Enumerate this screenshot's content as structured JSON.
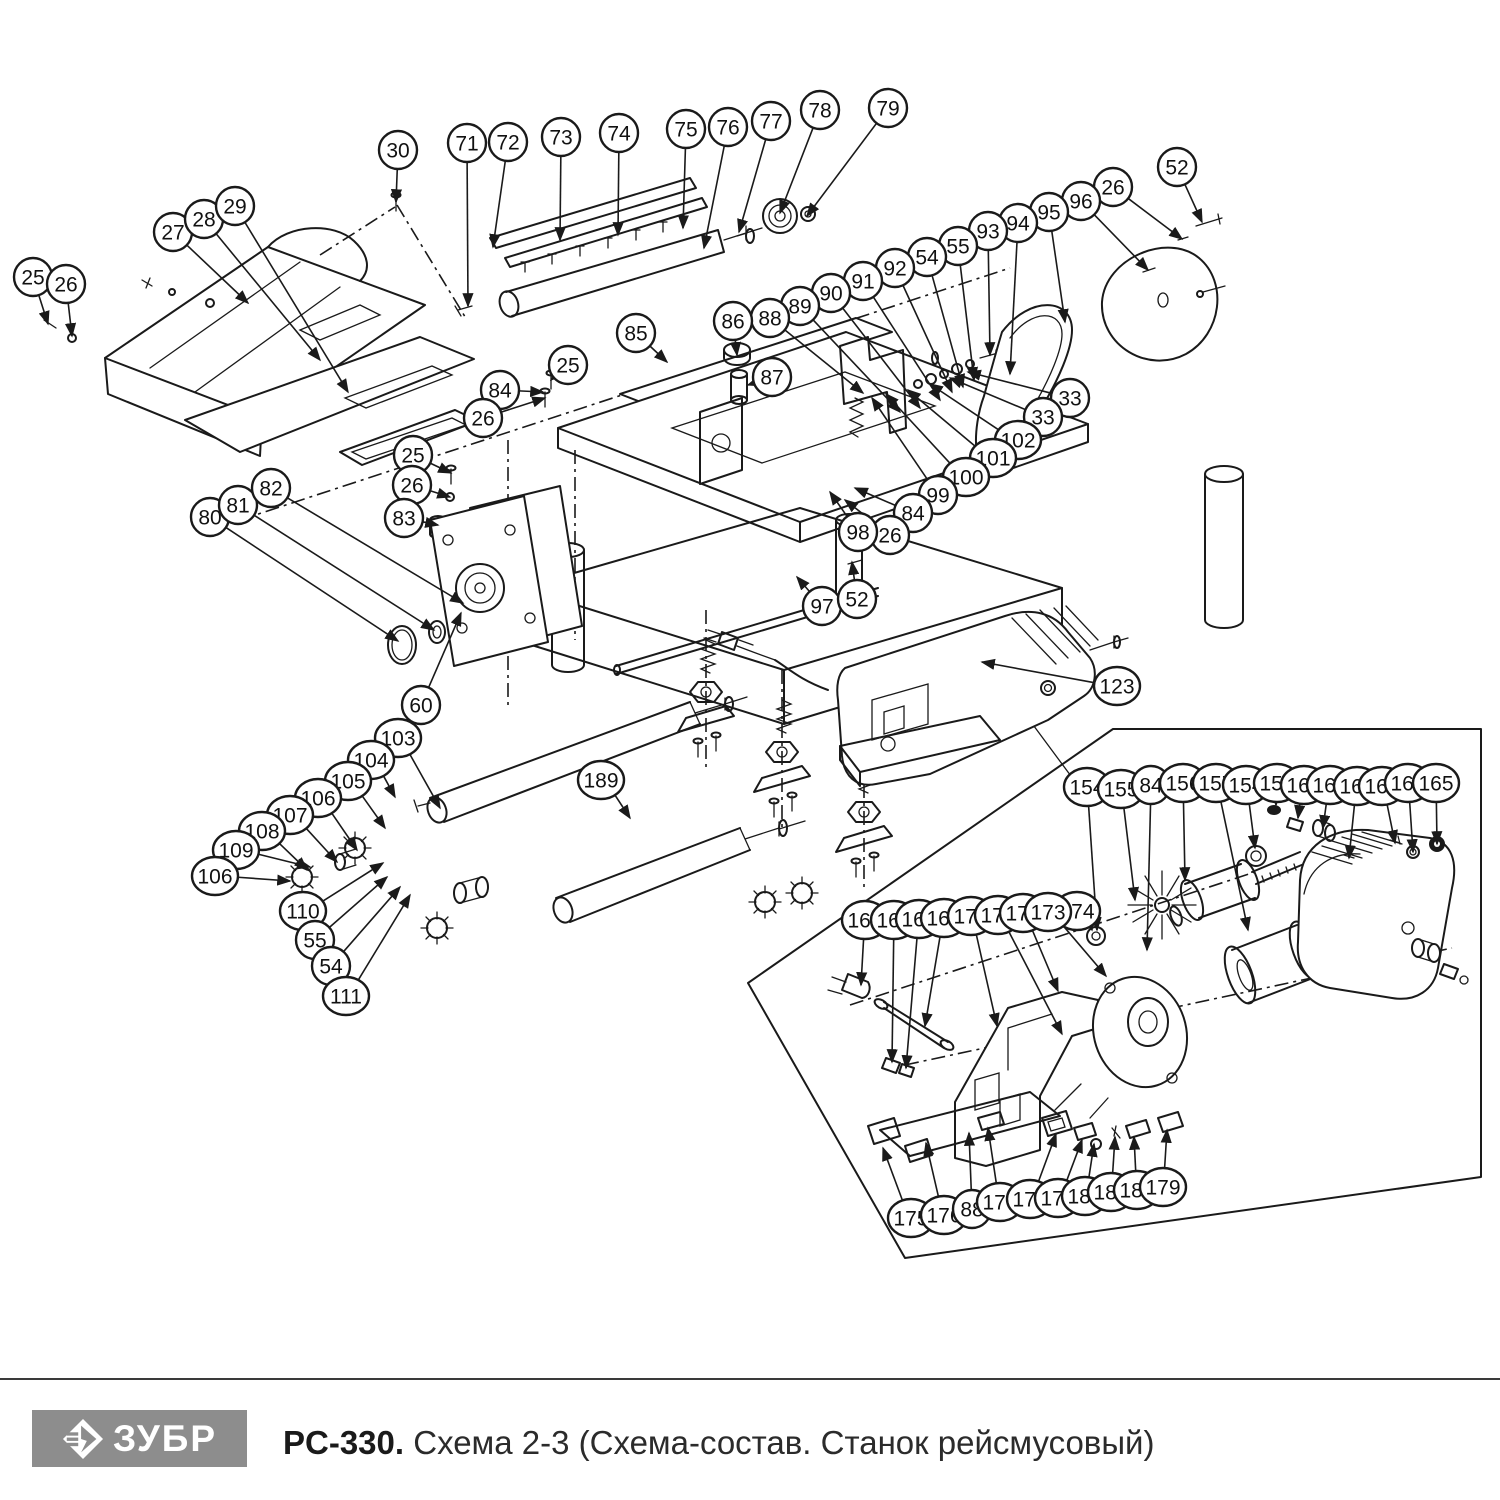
{
  "page": {
    "background": "#ffffff",
    "line_color": "#1a1a1a"
  },
  "footer": {
    "brand": "ЗУБР",
    "logo_icon": "zubr-diamond-arrow-icon",
    "logo_bg": "#8d8d8d",
    "logo_text_color": "#ffffff",
    "model": "PC-330.",
    "caption": " Схема 2-3 (Схема-состав. Станок рейсмусовый)"
  },
  "callouts": [
    {
      "n": "25",
      "x": 33,
      "y": 277,
      "tx": 48,
      "ty": 324
    },
    {
      "n": "26",
      "x": 66,
      "y": 284,
      "tx": 72,
      "ty": 336
    },
    {
      "n": "27",
      "x": 173,
      "y": 232,
      "tx": 248,
      "ty": 303
    },
    {
      "n": "28",
      "x": 204,
      "y": 219,
      "tx": 320,
      "ty": 360
    },
    {
      "n": "29",
      "x": 235,
      "y": 206,
      "tx": 348,
      "ty": 392
    },
    {
      "n": "30",
      "x": 398,
      "y": 150,
      "tx": 396,
      "ty": 202
    },
    {
      "n": "71",
      "x": 467,
      "y": 143,
      "tx": 468,
      "ty": 306
    },
    {
      "n": "72",
      "x": 508,
      "y": 142,
      "tx": 493,
      "ty": 247
    },
    {
      "n": "73",
      "x": 561,
      "y": 137,
      "tx": 560,
      "ty": 240
    },
    {
      "n": "74",
      "x": 619,
      "y": 133,
      "tx": 618,
      "ty": 235
    },
    {
      "n": "75",
      "x": 686,
      "y": 129,
      "tx": 683,
      "ty": 228
    },
    {
      "n": "76",
      "x": 728,
      "y": 127,
      "tx": 704,
      "ty": 248
    },
    {
      "n": "77",
      "x": 771,
      "y": 121,
      "tx": 739,
      "ty": 232
    },
    {
      "n": "78",
      "x": 820,
      "y": 110,
      "tx": 780,
      "ty": 213
    },
    {
      "n": "79",
      "x": 888,
      "y": 108,
      "tx": 807,
      "ty": 216
    },
    {
      "n": "52",
      "x": 1177,
      "y": 167,
      "tx": 1202,
      "ty": 222
    },
    {
      "n": "26",
      "x": 1113,
      "y": 187,
      "tx": 1182,
      "ty": 239
    },
    {
      "n": "96",
      "x": 1081,
      "y": 201,
      "tx": 1148,
      "ty": 270
    },
    {
      "n": "95",
      "x": 1049,
      "y": 212,
      "tx": 1065,
      "ty": 322
    },
    {
      "n": "94",
      "x": 1018,
      "y": 223,
      "tx": 1010,
      "ty": 374
    },
    {
      "n": "93",
      "x": 988,
      "y": 231,
      "tx": 990,
      "ty": 355
    },
    {
      "n": "55",
      "x": 958,
      "y": 246,
      "tx": 974,
      "ty": 380
    },
    {
      "n": "54",
      "x": 927,
      "y": 257,
      "tx": 963,
      "ty": 387
    },
    {
      "n": "92",
      "x": 895,
      "y": 268,
      "tx": 952,
      "ty": 392
    },
    {
      "n": "91",
      "x": 863,
      "y": 281,
      "tx": 940,
      "ty": 400
    },
    {
      "n": "90",
      "x": 831,
      "y": 293,
      "tx": 920,
      "ty": 408
    },
    {
      "n": "89",
      "x": 800,
      "y": 306,
      "tx": 900,
      "ty": 412
    },
    {
      "n": "88",
      "x": 770,
      "y": 318,
      "tx": 863,
      "ty": 393
    },
    {
      "n": "86",
      "x": 733,
      "y": 321,
      "tx": 737,
      "ty": 355
    },
    {
      "n": "87",
      "x": 772,
      "y": 377,
      "tx": 748,
      "ty": 385
    },
    {
      "n": "85",
      "x": 636,
      "y": 333,
      "tx": 667,
      "ty": 362
    },
    {
      "n": "25",
      "x": 568,
      "y": 365,
      "tx": 551,
      "ty": 380
    },
    {
      "n": "84",
      "x": 500,
      "y": 390,
      "tx": 543,
      "ty": 392
    },
    {
      "n": "26",
      "x": 483,
      "y": 418,
      "tx": 545,
      "ty": 398
    },
    {
      "n": "25",
      "x": 413,
      "y": 455,
      "tx": 451,
      "ty": 473
    },
    {
      "n": "26",
      "x": 412,
      "y": 485,
      "tx": 450,
      "ty": 497
    },
    {
      "n": "83",
      "x": 404,
      "y": 518,
      "tx": 438,
      "ty": 525
    },
    {
      "n": "80",
      "x": 210,
      "y": 517,
      "tx": 398,
      "ty": 641
    },
    {
      "n": "81",
      "x": 238,
      "y": 505,
      "tx": 434,
      "ty": 630
    },
    {
      "n": "82",
      "x": 271,
      "y": 488,
      "tx": 463,
      "ty": 603
    },
    {
      "n": "60",
      "x": 421,
      "y": 705,
      "tx": 461,
      "ty": 613
    },
    {
      "n": "33",
      "x": 1070,
      "y": 398,
      "tx": 968,
      "ty": 372
    },
    {
      "n": "33",
      "x": 1043,
      "y": 417,
      "tx": 950,
      "ty": 378
    },
    {
      "n": "102",
      "x": 1018,
      "y": 440,
      "tx": 930,
      "ty": 384
    },
    {
      "n": "101",
      "x": 993,
      "y": 458,
      "tx": 908,
      "ty": 390
    },
    {
      "n": "100",
      "x": 966,
      "y": 477,
      "tx": 886,
      "ty": 394
    },
    {
      "n": "99",
      "x": 938,
      "y": 495,
      "tx": 872,
      "ty": 398
    },
    {
      "n": "84",
      "x": 913,
      "y": 513,
      "tx": 855,
      "ty": 488
    },
    {
      "n": "26",
      "x": 890,
      "y": 535,
      "tx": 845,
      "ty": 500
    },
    {
      "n": "98",
      "x": 858,
      "y": 532,
      "tx": 830,
      "ty": 492
    },
    {
      "n": "97",
      "x": 822,
      "y": 606,
      "tx": 797,
      "ty": 577
    },
    {
      "n": "52",
      "x": 857,
      "y": 599,
      "tx": 852,
      "ty": 562
    },
    {
      "n": "103",
      "x": 398,
      "y": 738,
      "tx": 440,
      "ty": 808
    },
    {
      "n": "104",
      "x": 371,
      "y": 760,
      "tx": 395,
      "ty": 797
    },
    {
      "n": "105",
      "x": 348,
      "y": 781,
      "tx": 385,
      "ty": 828
    },
    {
      "n": "106",
      "x": 318,
      "y": 798,
      "tx": 357,
      "ty": 850
    },
    {
      "n": "107",
      "x": 290,
      "y": 815,
      "tx": 337,
      "ty": 862
    },
    {
      "n": "108",
      "x": 262,
      "y": 831,
      "tx": 307,
      "ty": 870
    },
    {
      "n": "109",
      "x": 236,
      "y": 850,
      "tx": 310,
      "ty": 867
    },
    {
      "n": "106",
      "x": 215,
      "y": 876,
      "tx": 290,
      "ty": 881
    },
    {
      "n": "110",
      "x": 303,
      "y": 911,
      "tx": 383,
      "ty": 863
    },
    {
      "n": "55",
      "x": 315,
      "y": 940,
      "tx": 387,
      "ty": 877
    },
    {
      "n": "54",
      "x": 331,
      "y": 966,
      "tx": 400,
      "ty": 887
    },
    {
      "n": "111",
      "x": 346,
      "y": 996,
      "tx": 410,
      "ty": 895
    },
    {
      "n": "189",
      "x": 601,
      "y": 780,
      "tx": 630,
      "ty": 818
    },
    {
      "n": "123",
      "x": 1117,
      "y": 686,
      "tx": 982,
      "ty": 662
    },
    {
      "n": "154",
      "x": 1087,
      "y": 787,
      "tx": 1097,
      "ty": 930
    },
    {
      "n": "155",
      "x": 1121,
      "y": 789,
      "tx": 1135,
      "ty": 900
    },
    {
      "n": "84",
      "x": 1151,
      "y": 785,
      "tx": 1147,
      "ty": 950
    },
    {
      "n": "156",
      "x": 1183,
      "y": 783,
      "tx": 1185,
      "ty": 880
    },
    {
      "n": "157",
      "x": 1216,
      "y": 783,
      "tx": 1248,
      "ty": 930
    },
    {
      "n": "154",
      "x": 1246,
      "y": 785,
      "tx": 1255,
      "ty": 848
    },
    {
      "n": "159",
      "x": 1277,
      "y": 783,
      "tx": 1276,
      "ty": 805
    },
    {
      "n": "160",
      "x": 1304,
      "y": 785,
      "tx": 1298,
      "ty": 818
    },
    {
      "n": "161",
      "x": 1330,
      "y": 785,
      "tx": 1323,
      "ty": 828
    },
    {
      "n": "162",
      "x": 1357,
      "y": 786,
      "tx": 1349,
      "ty": 858
    },
    {
      "n": "163",
      "x": 1382,
      "y": 786,
      "tx": 1395,
      "ty": 843
    },
    {
      "n": "164",
      "x": 1408,
      "y": 783,
      "tx": 1413,
      "ty": 852
    },
    {
      "n": "165",
      "x": 1436,
      "y": 783,
      "tx": 1437,
      "ty": 844
    },
    {
      "n": "174",
      "x": 1077,
      "y": 911,
      "tx": 1092,
      "ty": 930
    },
    {
      "n": "166",
      "x": 865,
      "y": 920,
      "tx": 861,
      "ty": 985
    },
    {
      "n": "167",
      "x": 894,
      "y": 920,
      "tx": 892,
      "ty": 1062
    },
    {
      "n": "168",
      "x": 919,
      "y": 919,
      "tx": 906,
      "ty": 1068
    },
    {
      "n": "169",
      "x": 944,
      "y": 918,
      "tx": 925,
      "ty": 1026
    },
    {
      "n": "170",
      "x": 971,
      "y": 916,
      "tx": 997,
      "ty": 1026
    },
    {
      "n": "171",
      "x": 998,
      "y": 915,
      "tx": 1062,
      "ty": 1034
    },
    {
      "n": "172",
      "x": 1023,
      "y": 913,
      "tx": 1058,
      "ty": 991
    },
    {
      "n": "173",
      "x": 1048,
      "y": 912,
      "tx": 1106,
      "ty": 976
    },
    {
      "n": "175",
      "x": 911,
      "y": 1218,
      "tx": 883,
      "ty": 1148
    },
    {
      "n": "176",
      "x": 944,
      "y": 1215,
      "tx": 926,
      "ty": 1143
    },
    {
      "n": "88",
      "x": 972,
      "y": 1209,
      "tx": 969,
      "ty": 1133
    },
    {
      "n": "177",
      "x": 1000,
      "y": 1202,
      "tx": 988,
      "ty": 1128
    },
    {
      "n": "178",
      "x": 1030,
      "y": 1199,
      "tx": 1056,
      "ty": 1134
    },
    {
      "n": "179",
      "x": 1058,
      "y": 1198,
      "tx": 1082,
      "ty": 1140
    },
    {
      "n": "180",
      "x": 1085,
      "y": 1196,
      "tx": 1094,
      "ty": 1144
    },
    {
      "n": "181",
      "x": 1111,
      "y": 1192,
      "tx": 1115,
      "ty": 1137
    },
    {
      "n": "182",
      "x": 1137,
      "y": 1190,
      "tx": 1134,
      "ty": 1137
    },
    {
      "n": "179",
      "x": 1163,
      "y": 1187,
      "tx": 1167,
      "ty": 1130
    }
  ]
}
